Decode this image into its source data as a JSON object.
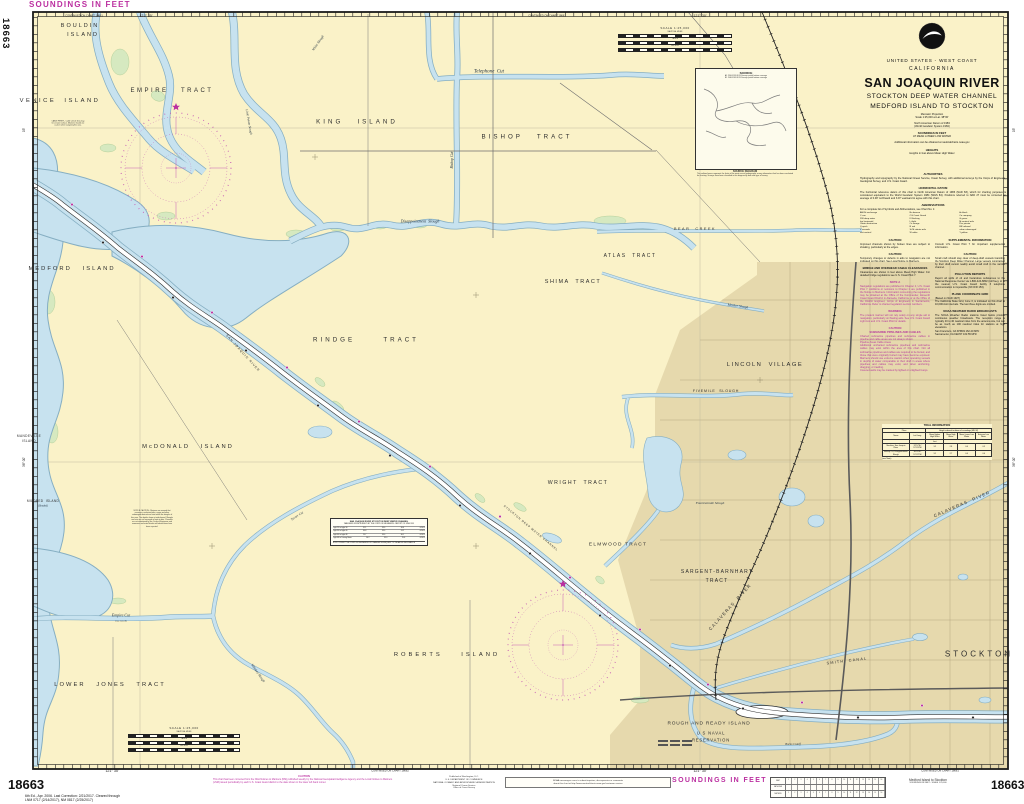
{
  "hdr": {
    "soundings_top": "SOUNDINGS IN FEET",
    "chart_no": "18663",
    "edition1": "6th Ed., Apr. 2006. Last Correction: 2/21/2017. Cleared through",
    "edition2": "LNM 0717 (2/14/2017), NM 0817 (2/25/2017)"
  },
  "title_block": {
    "us": "UNITED STATES - WEST COAST",
    "state": "CALIFORNIA",
    "title": "SAN JOAQUIN RIVER",
    "sub1": "STOCKTON DEEP WATER CHANNEL",
    "sub2": "MEDFORD ISLAND TO STOCKTON",
    "proj1": "Mercator Projection",
    "proj2": "Scale 1:25,000 at Lat. 38°00'",
    "datum1": "North American Datum of 1983",
    "datum2": "(World Geodetic System 1984)",
    "snd1": "SOUNDINGS IN FEET",
    "snd2": "AT MEAN LOWER LOW WATER",
    "extra": "Additional information can be obtained at nauticalcharts.noaa.gov",
    "hts1": "HEIGHTS",
    "hts2": "Heights in feet above Mean High Water"
  },
  "notes": {
    "abbreviations": [
      "ANCH anchorage",
      "Bn beacon",
      "bk black",
      "C can",
      "CG Coast Guard",
      "Co company",
      "DW deep water",
      "Fl flashing",
      "G green",
      "hor horizontal",
      "Lt light",
      "M nautical mile",
      "Obstn obstruction",
      "Or orange",
      "Priv private",
      "Q quick",
      "R red",
      "RR railroad",
      "s seconds",
      "St M statute mile",
      "subm submerged",
      "vert vertical",
      "W white",
      "Y yellow"
    ],
    "sections": [
      {
        "h": "AUTHORITIES",
        "b": "Hydrography and topography by the National Ocean Service, Coast Survey, with additional surveys by the Corps of Engineers, Geological Survey, and U.S. Coast Guard.",
        "c": "k",
        "col": "full"
      },
      {
        "h": "HORIZONTAL DATUM",
        "b": "The horizontal reference datum of this chart is North American Datum of 1983 (NAD 83), which for charting purposes is considered equivalent to the World Geodetic System 1984 (WGS 84). Positions referred to NAD 27 must be corrected an average of 0.48' northward and 3.97' eastward to agree with this chart.",
        "c": "k",
        "col": "full"
      },
      {
        "h": "ABBREVIATIONS",
        "b": "For a complete list of Symbols and Abbreviations, see Chart No. 1:",
        "c": "k",
        "col": "full",
        "grid": true
      },
      {
        "h": "CAUTION",
        "b": "Improved channels shown by broken lines are subject to shoaling, particularly at the edges.",
        "c": "k",
        "col": "a"
      },
      {
        "h": "CAUTION",
        "b": "Temporary changes or defects in aids to navigation are not indicated on this chart. See Local Notice to Mariners.",
        "c": "k",
        "col": "a"
      },
      {
        "h": "BRIDGE AND OVERHEAD CABLE CLEARANCES",
        "b": "Clearances are shown in feet above Mean High Water. For detailed bridge regulations see U.S. Coast Pilot 7.",
        "c": "k",
        "col": "a"
      },
      {
        "h": "NOTE A",
        "b": "Navigation regulations are published in Chapter 2, U.S. Coast Pilot 7. Additions or revisions to Chapter 2 are published in the Notice to Mariners. Information concerning the regulations may be obtained at the Office of the Commander, Eleventh Coast Guard District in Alameda, California, or at the Office of the District Engineer, Corps of Engineers in Sacramento, California. Refer to charted regulation section numbers.",
        "c": "m",
        "col": "a"
      },
      {
        "h": "WARNING",
        "b": "The prudent mariner will not rely solely on any single aid to navigation, particularly on floating aids. See U.S. Coast Guard Light List and U.S. Coast Pilot for details.",
        "c": "m",
        "col": "a"
      },
      {
        "h": "CAUTION\nSUBMARINE PIPELINES AND CABLES",
        "b": "Charted submarine pipelines and submarine cables in pipeline and cable areas are not always shown.\nPipeline Areas          Cable Areas\nAdditional uncharted submarine pipelines and submarine cables may exist within the area of this chart. Not all submarine pipelines and cables are required to be buried, and those that were originally buried may have become exposed. Mariners should use extreme caution when operating vessels in depths of water comparable to their draft in areas where pipelines and cables may exist, and when anchoring, dragging, or trawling.\nCovered wells may be marked by lighted or unlighted buoys.",
        "c": "m",
        "col": "a"
      },
      {
        "h": "SUPPLEMENTAL INFORMATION",
        "b": "Consult U.S. Coast Pilot 7 for important supplemental information.",
        "c": "k",
        "col": "b"
      },
      {
        "h": "CAUTION",
        "b": "Small craft should stay clear of deep-draft vessels transiting the Stockton Deep Water Channel. Large vessels constrained by their draft cannot readily avoid small craft in the narrow channel.",
        "c": "k",
        "col": "b"
      },
      {
        "h": "POLLUTION REPORTS",
        "b": "Report all spills of oil and hazardous substances to the National Response Center via 1-800-424-8802 (toll free), or to the nearest U.S. Coast Guard facility if telephone communication is impossible (33 CFR 153).",
        "c": "k",
        "col": "b"
      },
      {
        "h": "PLANE COORDINATE GRID",
        "b": "(Based on NAD 1927)\nThe California State Grid, zone 3, is indicated on this chart at 10,000-foot intervals. The last three digits are omitted.",
        "c": "k",
        "col": "b"
      },
      {
        "h": "NOAA WEATHER RADIO BROADCASTS",
        "b": "The NOAA Weather Radio stations listed below provide continuous weather broadcasts. The reception range is typically 20 to 40 nautical miles from the antenna site, but can be as much as 100 nautical miles for stations at high elevations.\nSan Francisco, CA   KHB49   162.40 MHz\nSacramento, CA      KEC57   162.55 MHz",
        "c": "k",
        "col": "b"
      }
    ]
  },
  "tidal_table": {
    "title": "TIDAL INFORMATION",
    "place": "Place",
    "span": "Height referred to datum of soundings (MLLW)",
    "name": "Name",
    "latlong": "Lat./Long.",
    "cols": [
      "Mean Higher High Water",
      "Mean High Water",
      "Mean Lower Low Water",
      "Extreme Low Water"
    ],
    "unit": "feet",
    "rows": [
      [
        "Stockton, San Joaquin River",
        "37°57'N / 121°20'W",
        "3.2",
        "2.8",
        "0.0",
        "-1.5"
      ],
      [
        "Bishop Cut, Disappointment Slough",
        "38°03'N / 121°25'W",
        "3.1",
        "2.7",
        "0.0",
        "-1.4"
      ]
    ],
    "note": "(see Note)"
  },
  "source_box": {
    "title": "SOURCE",
    "row1": "A1   1990-1999   NOS Surveys   partial bottom coverage",
    "row2": "B1   1940-1969   NOS Surveys   partial bottom coverage",
    "caption": "SOURCE DIAGRAM",
    "note": "The outlined areas represent the limits of the most recent hydrographic survey information that has been evaluated for charting. Surveys have been classified in this diagram by date and type of survey."
  },
  "chan_table": {
    "t1": "SAN JOAQUIN RIVER STOCKTON DEEP WATER CHANNEL",
    "t2": "TABULATED FROM SURVEYS BY THE CORPS OF ENGINEERS - REPORT OF JUNE 2015",
    "rows": [
      [
        "Light 23 to Light 30",
        "31.1",
        "35.0",
        "30.6",
        "6-2015"
      ],
      [
        "Light 30 to Light 40",
        "30.8",
        "35.0",
        "31.2",
        "6-2015"
      ],
      [
        "Light 40 to Light 48",
        "29.7",
        "35.0",
        "30.1",
        "6-2015"
      ],
      [
        "Light 48 to Turning Basin",
        "30.2",
        "35.0",
        "29.8",
        "6-2015"
      ]
    ],
    "note": "NOTE: CONSULT THE CORPS OF ENGINEERS FOR CHANGES SUBSEQUENT TO THE ABOVE INFORMATION"
  },
  "scale": {
    "label": "SCALE 1:25,000",
    "nm": "NAUTICAL MILES",
    "yd": "YARDS",
    "m": "METERS"
  },
  "conversion": {
    "rows": [
      "FEET",
      "FATHOMS",
      "METERS"
    ]
  },
  "bottom": {
    "caution_h": "CAUTION",
    "caution_b": "This chart has been corrected from the NGA Notices to Mariners (NM) published weekly by the National Geospatial-Intelligence Agency and the Local Notices to Mariners (LNM) issued periodically by each U.S. Coast Guard district to the date shown in the lower left hand corner.",
    "p1": "Published at Washington, D.C.",
    "p2": "U.S. DEPARTMENT OF COMMERCE",
    "p3": "NATIONAL OCEANIC AND ATMOSPHERIC ADMINISTRATION",
    "p4": "National Ocean Service",
    "p5": "Office of Coast Survey",
    "inquiry1": "NOAA encourages users to submit inquiries, discrepancies or comments",
    "inquiry2": "about this chart at http://www.nauticalcharts.noaa.gov/customer-service",
    "soundings": "SOUNDINGS IN FEET",
    "medford1": "Medford Island to Stockton",
    "medford2": "SOUNDINGS IN FEET - SCALE 1:25,000"
  },
  "map_labels": [
    {
      "t": "BOULDIN",
      "x": 80,
      "y": 26,
      "s": 5.5,
      "sp": 2,
      "k": "land"
    },
    {
      "t": "ISLAND",
      "x": 83,
      "y": 35,
      "s": 5.5,
      "sp": 2,
      "k": "land"
    },
    {
      "t": "VENICE  ISLAND",
      "x": 60,
      "y": 101,
      "s": 5.8,
      "sp": 2.5,
      "k": "land"
    },
    {
      "t": "EMPIRE   TRACT",
      "x": 172,
      "y": 91,
      "s": 6,
      "sp": 2.5,
      "k": "land"
    },
    {
      "t": "KING   ISLAND",
      "x": 357,
      "y": 122,
      "s": 6.2,
      "sp": 3,
      "k": "land"
    },
    {
      "t": "BISHOP   TRACT",
      "x": 527,
      "y": 137,
      "s": 6.2,
      "sp": 3,
      "k": "land"
    },
    {
      "t": "ATLAS  TRACT",
      "x": 630,
      "y": 256,
      "s": 5,
      "sp": 1.5,
      "k": "land"
    },
    {
      "t": "SHIMA  TRACT",
      "x": 573,
      "y": 282,
      "s": 5.5,
      "sp": 1.5,
      "k": "land"
    },
    {
      "t": "MEDFORD   ISLAND",
      "x": 72,
      "y": 269,
      "s": 5.8,
      "sp": 2,
      "k": "land"
    },
    {
      "t": "RINDGE      TRACT",
      "x": 366,
      "y": 340,
      "s": 6.2,
      "sp": 3,
      "k": "land"
    },
    {
      "t": "McDONALD   ISLAND",
      "x": 188,
      "y": 447,
      "s": 5.8,
      "sp": 2,
      "k": "land"
    },
    {
      "t": "WRIGHT  TRACT",
      "x": 578,
      "y": 483,
      "s": 5.2,
      "sp": 1.5,
      "k": "land"
    },
    {
      "t": "ELMWOOD TRACT",
      "x": 618,
      "y": 545,
      "s": 4.8,
      "sp": 1.2,
      "k": "land"
    },
    {
      "t": "SARGENT-BARNHART",
      "x": 717,
      "y": 572,
      "s": 5,
      "sp": 1.2,
      "k": "land"
    },
    {
      "t": "TRACT",
      "x": 717,
      "y": 581,
      "s": 5,
      "sp": 1.2,
      "k": "land"
    },
    {
      "t": "LINCOLN  VILLAGE",
      "x": 765,
      "y": 365,
      "s": 5.8,
      "sp": 1.5,
      "k": "land"
    },
    {
      "t": "STOCKTON",
      "x": 979,
      "y": 654,
      "s": 8,
      "sp": 3,
      "k": "land"
    },
    {
      "t": "ROBERTS    ISLAND",
      "x": 447,
      "y": 655,
      "s": 5.8,
      "sp": 3,
      "k": "land"
    },
    {
      "t": "LOWER   JONES   TRACT",
      "x": 110,
      "y": 685,
      "s": 5.8,
      "sp": 2,
      "k": "land"
    },
    {
      "t": "ROUGH AND READY ISLAND",
      "x": 709,
      "y": 724,
      "s": 4.8,
      "sp": 0.8,
      "k": "land"
    },
    {
      "t": "U S NAVAL",
      "x": 711,
      "y": 733,
      "s": 4.2,
      "sp": 0.8,
      "k": "land"
    },
    {
      "t": "RESERVATION",
      "x": 711,
      "y": 740,
      "s": 4.2,
      "sp": 0.8,
      "k": "land"
    },
    {
      "t": "MANDEVILLE",
      "x": 29,
      "y": 436,
      "s": 3.2,
      "sp": 0.4,
      "k": "land"
    },
    {
      "t": "ISLAND",
      "x": 29,
      "y": 441,
      "s": 3.2,
      "sp": 0.4,
      "k": "land"
    },
    {
      "t": "MILDRED  ISLAND",
      "x": 43,
      "y": 501,
      "s": 3.2,
      "sp": 0.3,
      "k": "land"
    },
    {
      "t": "(flooded)",
      "x": 43,
      "y": 506,
      "s": 2.6,
      "k": "water"
    },
    {
      "t": "Telephone  Cut",
      "x": 489,
      "y": 72,
      "s": 5,
      "k": "water"
    },
    {
      "t": "Disappointment  Slough",
      "x": 420,
      "y": 221,
      "s": 4,
      "k": "water"
    },
    {
      "t": "Bishop Cut",
      "x": 452,
      "y": 160,
      "s": 3.8,
      "r": -90,
      "k": "water"
    },
    {
      "t": "BEAR  CREEK",
      "x": 695,
      "y": 229,
      "s": 3.8,
      "sp": 1.5,
      "k": "land"
    },
    {
      "t": "Mosher Slough",
      "x": 738,
      "y": 306,
      "s": 3.4,
      "r": 8,
      "k": "water"
    },
    {
      "t": "FIVEMILE  SLOUGH",
      "x": 716,
      "y": 391,
      "s": 3.6,
      "sp": 0.8,
      "k": "land"
    },
    {
      "t": "Fourteenmile Slough",
      "x": 710,
      "y": 503,
      "s": 3.4,
      "k": "water"
    },
    {
      "t": "CALAVERAS  RIVER",
      "x": 962,
      "y": 504,
      "s": 4.4,
      "sp": 1.2,
      "r": -23,
      "k": "land"
    },
    {
      "t": "CALAVERAS  RIVER",
      "x": 730,
      "y": 607,
      "s": 4.4,
      "sp": 1.2,
      "r": -48,
      "k": "land"
    },
    {
      "t": "SMITH  CANAL",
      "x": 847,
      "y": 661,
      "s": 3.8,
      "sp": 1.2,
      "r": -7,
      "k": "land"
    },
    {
      "t": "Empire Cut",
      "x": 121,
      "y": 615,
      "s": 4,
      "k": "water"
    },
    {
      "t": "(see note B)",
      "x": 121,
      "y": 621,
      "s": 2.4,
      "k": "water"
    },
    {
      "t": "Whiskey Slough",
      "x": 258,
      "y": 673,
      "s": 3.4,
      "r": 55,
      "k": "water"
    },
    {
      "t": "White Slough",
      "x": 318,
      "y": 43,
      "s": 3.4,
      "r": -55,
      "k": "water"
    },
    {
      "t": "Little Potato Slough",
      "x": 249,
      "y": 122,
      "s": 3.2,
      "r": 80,
      "k": "water"
    },
    {
      "t": "SAN JOAQUIN RIVER",
      "x": 243,
      "y": 353,
      "s": 3.2,
      "sp": 1,
      "r": 48,
      "k": "land"
    },
    {
      "t": "STOCKTON DEEP WATER CHANNEL",
      "x": 531,
      "y": 528,
      "s": 2.8,
      "sp": 0.8,
      "r": 40,
      "k": "land"
    },
    {
      "t": "Burns Cutoff",
      "x": 793,
      "y": 744,
      "s": 3,
      "k": "water"
    },
    {
      "t": "Turner Cut",
      "x": 297,
      "y": 516,
      "s": 3.2,
      "r": -33,
      "k": "water"
    },
    {
      "t": "CABLE FERRY - Cable vehicle ferry may be at water surface. Mariners should use caution when navigating this area.",
      "x": 68,
      "y": 124,
      "s": 1.8,
      "k": "tiny",
      "w": 34
    },
    {
      "t": "NOTE B CAUTION - Mariners are warned that numerous uncharted piles, snags and other submerged obstructions exist within the sloughs of this area. The depths shown at midchannel. Sloughs and cuts are not surveyed or kept at date. Channels are not maintained by the Corps of Engineers and numerous uncharted shoals and obstructions have been reported.",
      "x": 152,
      "y": 519,
      "s": 1.8,
      "k": "tiny",
      "w": 42
    }
  ],
  "border_labels": [
    {
      "t": "CONTINUED ON CHART 18661",
      "x": 84,
      "y": 15.5,
      "s": 2.6
    },
    {
      "t": "121° 35'",
      "x": 146,
      "y": 15.5,
      "s": 3.6
    },
    {
      "t": "CONTINUED ON CHART 18661",
      "x": 547,
      "y": 15.5,
      "s": 2.6
    },
    {
      "t": "121° 30'",
      "x": 700,
      "y": 15.5,
      "s": 3.6
    },
    {
      "t": "121° 35'",
      "x": 112,
      "y": 770.5,
      "s": 3.6
    },
    {
      "t": "CONTINUED ON CHART 18662",
      "x": 390,
      "y": 770.5,
      "s": 2.6
    },
    {
      "t": "121° 30'",
      "x": 700,
      "y": 770.5,
      "s": 3.6
    },
    {
      "t": "CONTINUED ON CHART 18661",
      "x": 940,
      "y": 770.5,
      "s": 2.6
    },
    {
      "t": "38° 00'",
      "x": 24,
      "y": 462,
      "s": 3.2,
      "r": -90
    },
    {
      "t": "05'",
      "x": 24,
      "y": 130,
      "s": 3.2,
      "r": -90
    },
    {
      "t": "38° 00'",
      "x": 1014,
      "y": 462,
      "s": 3.2,
      "r": -90
    },
    {
      "t": "05'",
      "x": 1014,
      "y": 130,
      "s": 3.2,
      "r": -90
    }
  ],
  "colors": {
    "land": "#faf2c8",
    "urban": "#e6d9ad",
    "water": "#c7e2ef",
    "water_edge": "#85aec2",
    "marsh": "#d6e9c0",
    "magenta": "#bb2fa0",
    "rose": "#c75fb5",
    "neatline": "#1a1a1a"
  }
}
